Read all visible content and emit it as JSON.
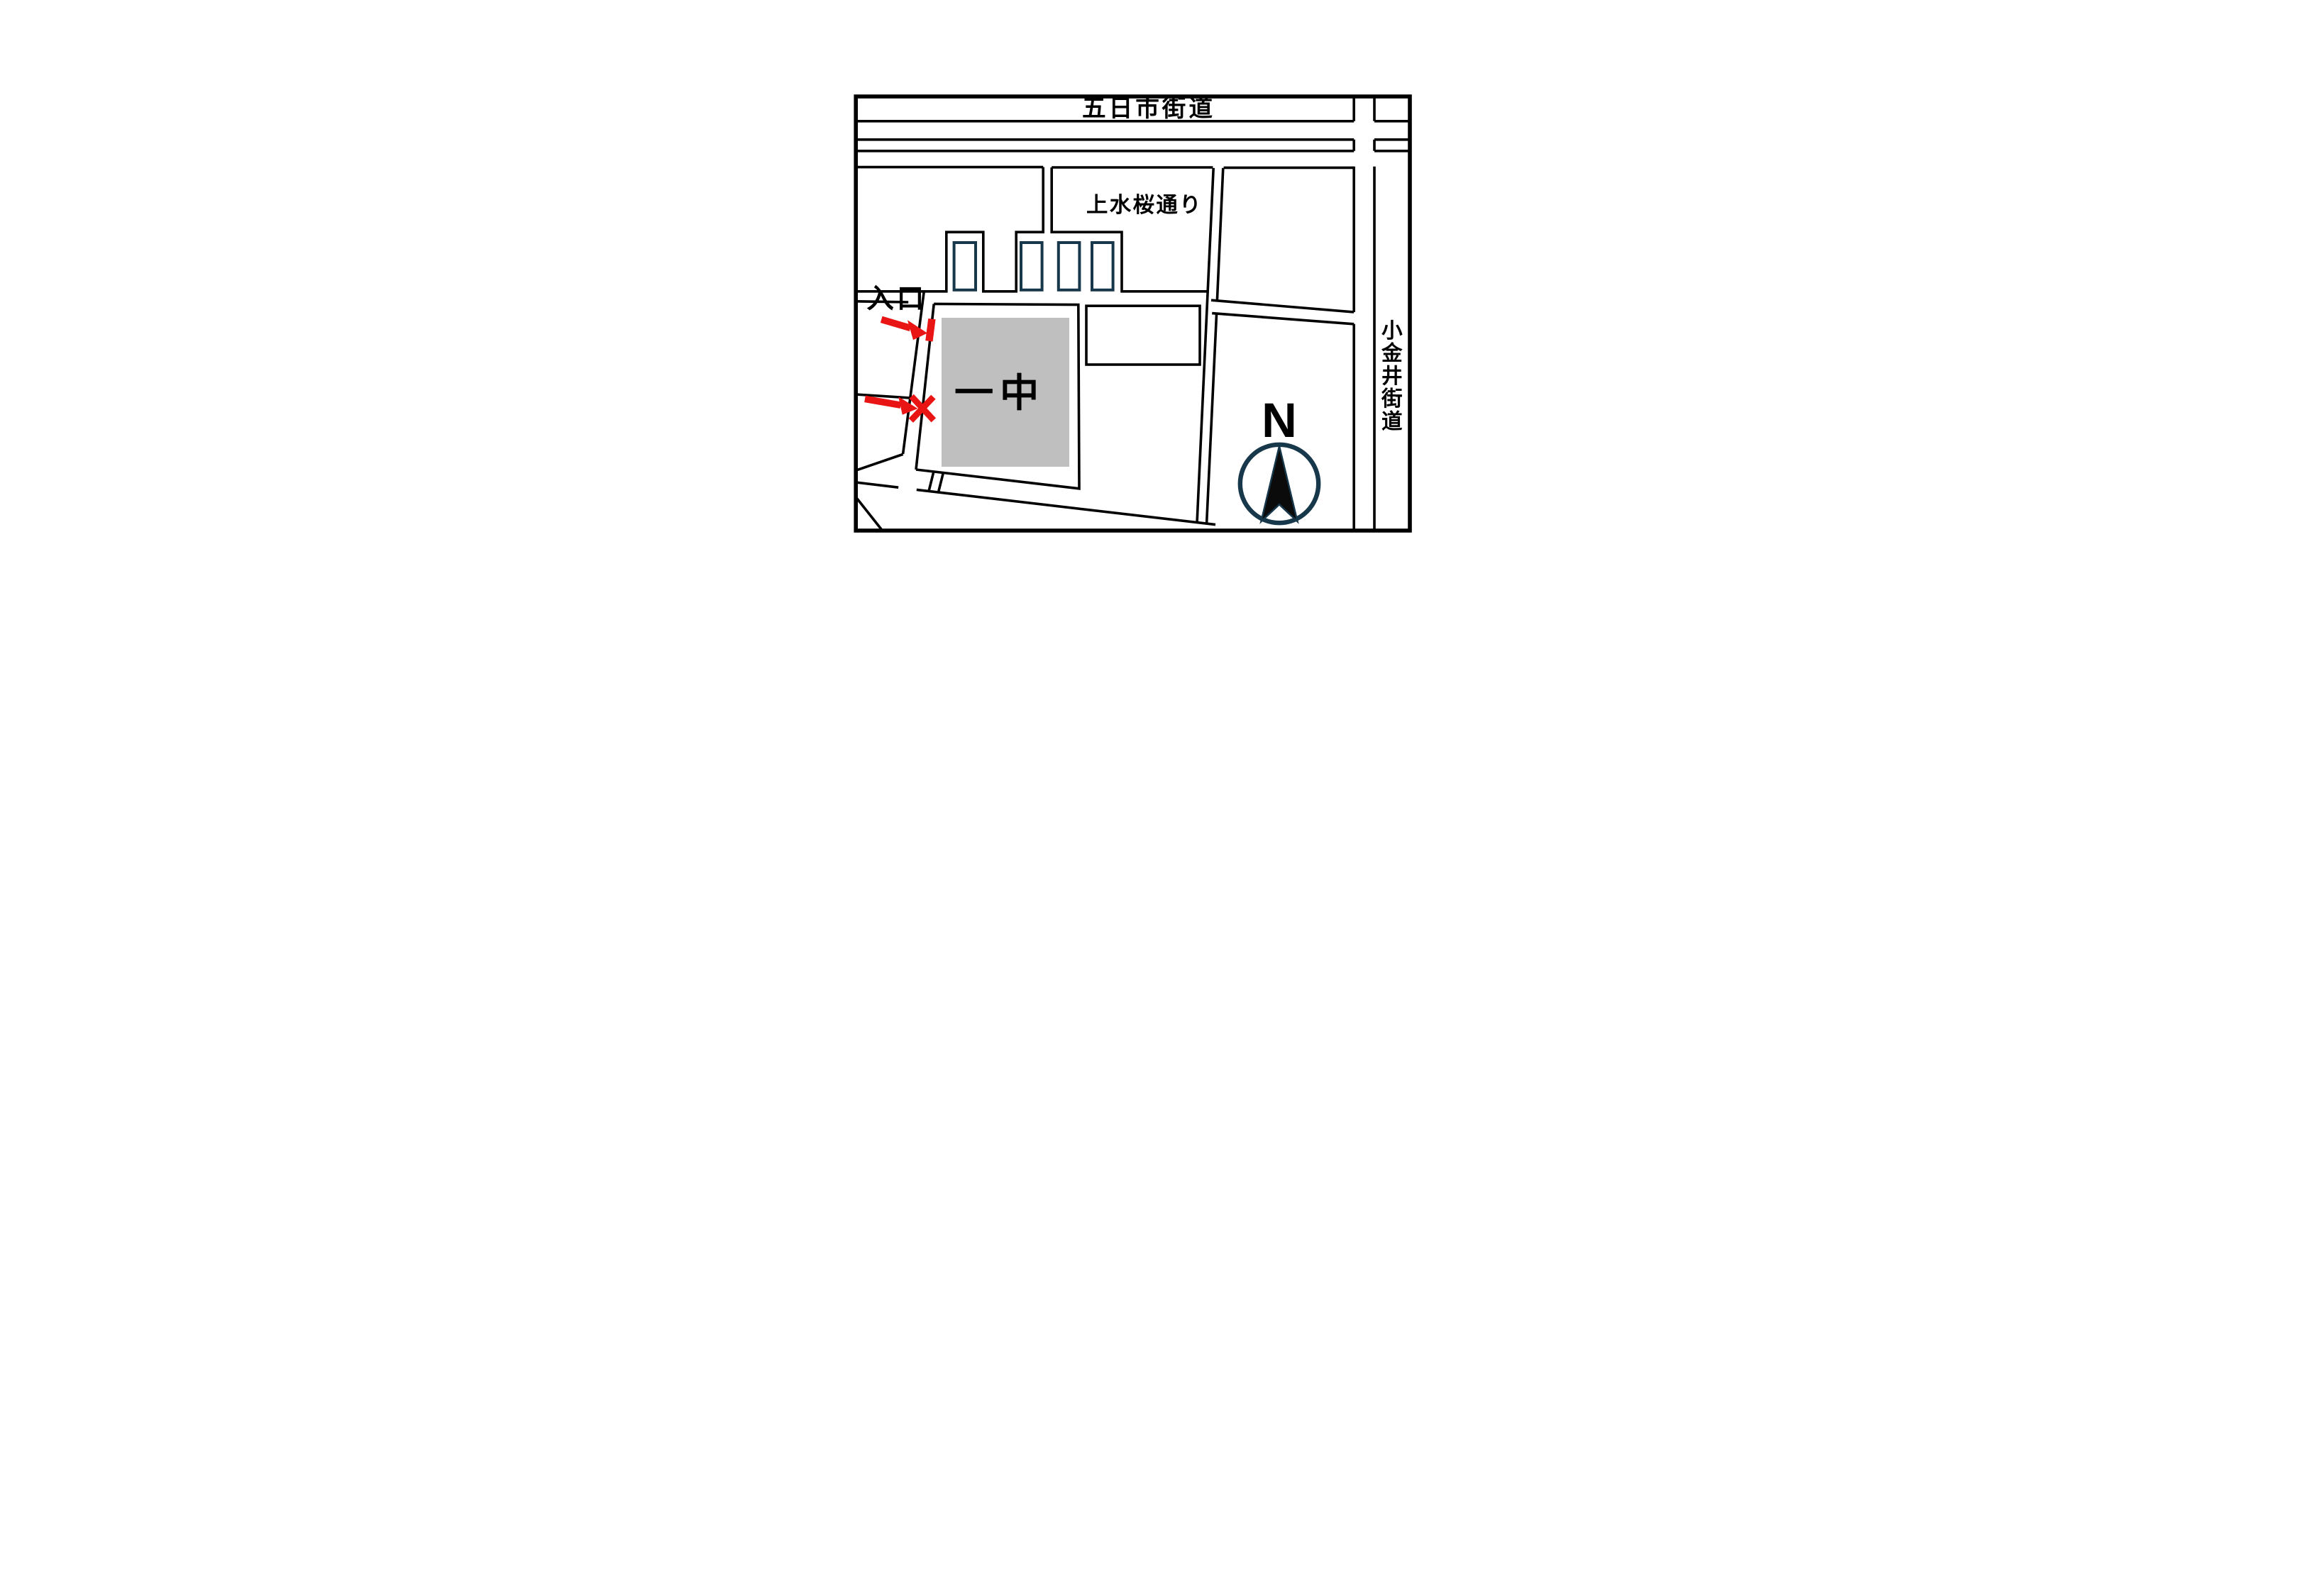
{
  "map": {
    "top_road_label": "五日市街道",
    "sakura_street_label": "上水桜通り",
    "right_road_label": "小金井街道",
    "school_label": "一中",
    "entrance_label": "入口",
    "compass_letter": "N",
    "markers": {
      "entrance_tick": "entrance position tick",
      "x_mark": "meeting point x mark"
    },
    "colors": {
      "line_black": "#000000",
      "building_outline_navy": "#17374a",
      "school_fill_gray": "#bfbfbf",
      "marker_red": "#e91414"
    }
  }
}
